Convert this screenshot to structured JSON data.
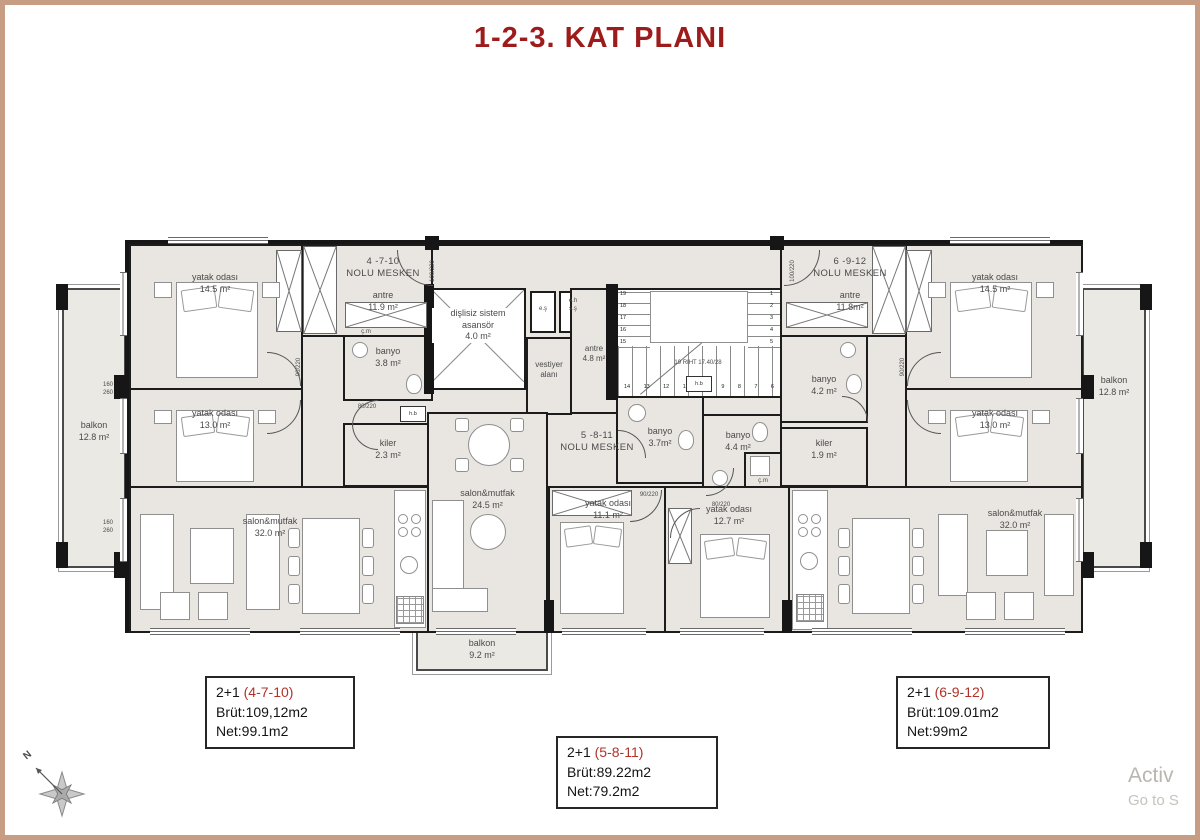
{
  "title": "1-2-3. KAT PLANI",
  "apartments": {
    "left": {
      "unit_label": "4 -7-10\nNOLU MESKEN",
      "rooms": {
        "antre": "antre\n11.9 m²",
        "bed1": "yatak odası\n14.5 m²",
        "bed2": "yatak odası\n13.0 m²",
        "banyo": "banyo\n3.8 m²",
        "kiler": "kiler\n2.3 m²",
        "salon": "salon&mutfak\n32.0 m²",
        "balkon": "balkon\n12.8 m²",
        "cm": "ç.m"
      },
      "info": {
        "type": "2+1",
        "unit": "(4-7-10)",
        "brut": "Brüt:109,12m2",
        "net": "Net:99.1m2"
      }
    },
    "center": {
      "unit_label": "5 -8-11\nNOLU MESKEN",
      "rooms": {
        "antre": "antre\n4.8 m²",
        "banyo1": "banyo\n3.7m²",
        "banyo2": "banyo\n4.4 m²",
        "salon": "salon&mutfak\n24.5 m²",
        "bed1": "yatak odası\n11.1 m²",
        "bed2": "yatak odası\n12.7 m²",
        "balkon": "balkon\n9.2 m²",
        "cm": "ç.m"
      },
      "info": {
        "type": "2+1",
        "unit": "(5-8-11)",
        "brut": "Brüt:89.22m2",
        "net": "Net:79.2m2"
      }
    },
    "right": {
      "unit_label": "6 -9-12\nNOLU MESKEN",
      "rooms": {
        "antre": "antre\n11.8m²",
        "banyo": "banyo\n4.2 m²",
        "kiler": "kiler\n1.9 m²",
        "bed1": "yatak odası\n14.5 m²",
        "bed2": "yatak odası\n13.0 m²",
        "salon": "salon&mutfak\n32.0 m²",
        "balkon": "balkon\n12.8 m²"
      },
      "info": {
        "type": "2+1",
        "unit": "(6-9-12)",
        "brut": "Brüt:109.01m2",
        "net": "Net:99m2"
      }
    }
  },
  "core": {
    "elevator": "dişlisiz sistem\nasansör\n4.0 m²",
    "vestiyer": "vestiyer\nalanı",
    "shaft1": "e.ş",
    "shaft2": "e.h\ns.ş",
    "stairs_note": "19 RIHT 17.40/28",
    "stair_left": [
      "19",
      "18",
      "17",
      "16",
      "15"
    ],
    "stair_right": [
      "1",
      "2",
      "3",
      "4",
      "5"
    ],
    "stair_bottom": [
      "14",
      "13",
      "12",
      "11",
      "10",
      "9",
      "8",
      "7",
      "6"
    ]
  },
  "annotations": {
    "door_100": "100/220",
    "door_90": "90/220",
    "door_80": "80/220",
    "win_160": "160\n260",
    "hb": "h.b"
  },
  "compass": {
    "north_label": "N"
  },
  "watermark": {
    "line1": "Activ",
    "line2": "Go to S"
  }
}
